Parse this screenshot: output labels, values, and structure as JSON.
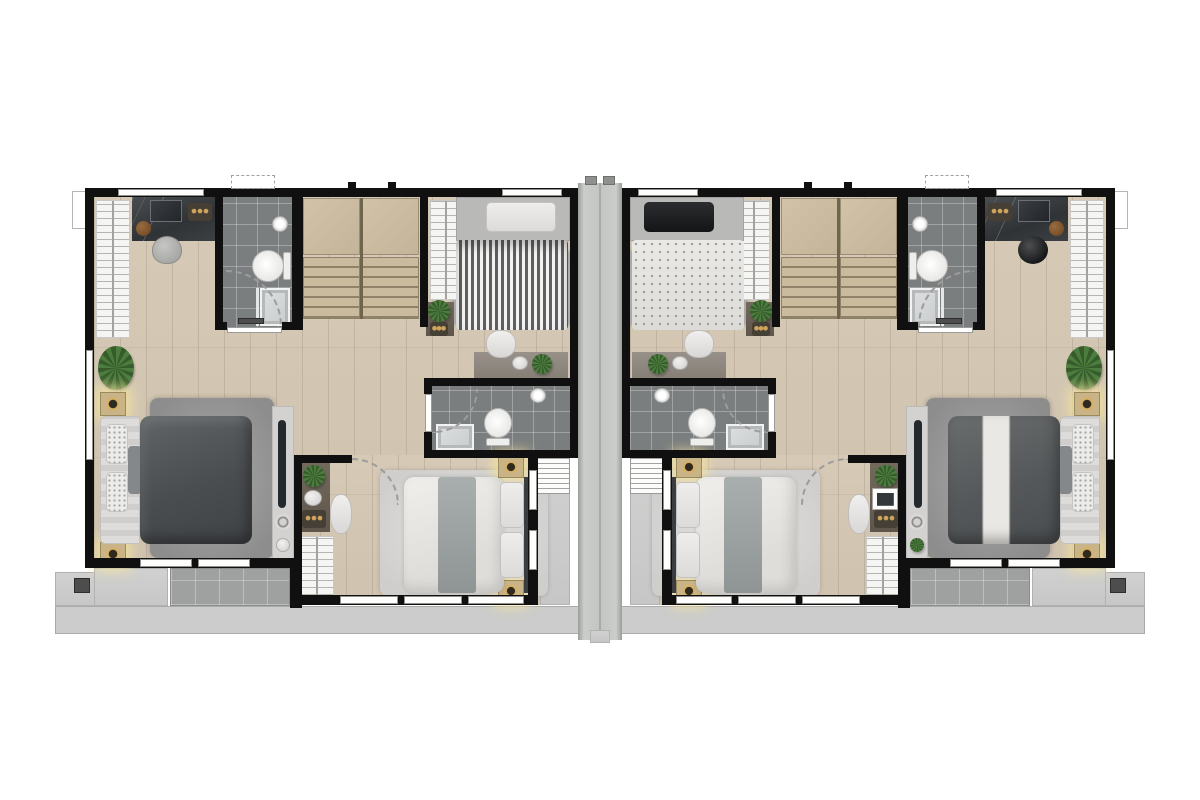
{
  "meta": {
    "description": "Top-down architectural floor plan rendering of two mirrored duplex townhouse units separated by a central concrete party wall; no visible text labels in the image",
    "units": [
      "left-unit",
      "right-unit"
    ],
    "rooms_per_unit": [
      "master-bedroom",
      "bathroom-top",
      "stairs",
      "bedroom-single",
      "bathroom-mid",
      "bedroom-double",
      "balconies"
    ]
  },
  "canvas": {
    "width": 1200,
    "height": 800,
    "background": "#ffffff"
  },
  "palette": {
    "wall": "#101010",
    "wood_floor": "#d2c6b3",
    "bathroom_tile": "#7b7e7f",
    "balcony_tile": "#9fa1a0",
    "concrete": "#c8c9c8",
    "divider_concrete": "#c3c5c3",
    "stairs": "#c4b499",
    "wardrobe": "#f5f5f4",
    "dark_bed": "#4a4d50",
    "white_bed": "#eceae7",
    "rug": "#999999",
    "lamp_glow": "#f3e2a0",
    "plant": "#4c7c3e"
  },
  "shapes": [
    {
      "name": "ground-strip",
      "cls": "concrete-strip",
      "x": 55,
      "y": 606,
      "w": 1090,
      "h": 28,
      "mirror": false
    },
    {
      "name": "side-ledge",
      "cls": "concrete-light",
      "x": 55,
      "y": 572,
      "w": 40,
      "h": 34
    },
    {
      "name": "drain-box",
      "cls": "dark-box",
      "x": 74,
      "y": 578,
      "w": 16,
      "h": 15
    },
    {
      "name": "roof-outline-box",
      "cls": "outline-box",
      "x": 72,
      "y": 191,
      "w": 68,
      "h": 38
    },
    {
      "name": "wood-floor-main",
      "cls": "wood",
      "x": 94,
      "y": 197,
      "w": 476,
      "h": 371
    },
    {
      "name": "wood-floor-bedroom2",
      "cls": "wood",
      "x": 294,
      "y": 455,
      "w": 276,
      "h": 150
    },
    {
      "name": "master-balcony-plain",
      "cls": "concrete-light",
      "x": 94,
      "y": 568,
      "w": 74,
      "h": 38
    },
    {
      "name": "master-balcony-tiled",
      "cls": "tile-balcony",
      "x": 170,
      "y": 568,
      "w": 120,
      "h": 38
    },
    {
      "name": "side-balcony",
      "cls": "concrete-light",
      "x": 540,
      "y": 455,
      "w": 30,
      "h": 150
    },
    {
      "name": "bathroom-top-floor",
      "cls": "tile-dark",
      "x": 215,
      "y": 197,
      "w": 85,
      "h": 133
    },
    {
      "name": "stair-landing-a",
      "cls": "stair-landing",
      "x": 303,
      "y": 198,
      "w": 57,
      "h": 57
    },
    {
      "name": "stair-landing-b",
      "cls": "stair-landing",
      "x": 362,
      "y": 198,
      "w": 57,
      "h": 57
    },
    {
      "name": "stair-flight-a",
      "cls": "stairs",
      "x": 303,
      "y": 257,
      "w": 57,
      "h": 62
    },
    {
      "name": "stair-flight-b",
      "cls": "stairs",
      "x": 362,
      "y": 257,
      "w": 57,
      "h": 62
    },
    {
      "name": "stair-rail",
      "cls": "rail",
      "x": 360,
      "y": 198,
      "w": 3,
      "h": 121
    },
    {
      "name": "bathroom-mid-floor",
      "cls": "tile-dark",
      "x": 428,
      "y": 382,
      "w": 142,
      "h": 72
    },
    {
      "name": "master-rug",
      "cls": "rug-dark",
      "x": 150,
      "y": 398,
      "w": 124,
      "h": 160
    },
    {
      "name": "single-bed-rug",
      "cls": "rug-gray",
      "x": 452,
      "y": 250,
      "w": 120,
      "h": 76
    },
    {
      "name": "bedroom2-rug",
      "cls": "rug-light",
      "x": 380,
      "y": 470,
      "w": 168,
      "h": 126
    },
    {
      "name": "master-wardrobe",
      "cls": "wardrobe-v",
      "x": 96,
      "y": 200,
      "w": 34,
      "h": 138
    },
    {
      "name": "vanity-counter",
      "cls": "marble",
      "x": 132,
      "y": 197,
      "w": 84,
      "h": 44
    },
    {
      "name": "vanity-mirror",
      "cls": "mirror-frame",
      "x": 150,
      "y": 200,
      "w": 32,
      "h": 22
    },
    {
      "name": "vanity-stool",
      "cls": "stool-brown",
      "x": 136,
      "y": 221,
      "w": 15,
      "h": 15
    },
    {
      "name": "vanity-tray",
      "cls": "tray-dark",
      "x": 188,
      "y": 203,
      "w": 24,
      "h": 18
    },
    {
      "name": "vanity-chair",
      "cls": "chair-gray",
      "x": 152,
      "y": 236,
      "w": 30,
      "h": 28,
      "rcls": "stool-black"
    },
    {
      "name": "corner-plant",
      "cls": "plant",
      "x": 98,
      "y": 346,
      "w": 36,
      "h": 44
    },
    {
      "name": "master-lamp-top",
      "cls": "lamp",
      "x": 100,
      "y": 392,
      "w": 26,
      "h": 24
    },
    {
      "name": "master-lamp-bottom",
      "cls": "lamp",
      "x": 100,
      "y": 542,
      "w": 26,
      "h": 24
    },
    {
      "name": "master-bed-sheet",
      "cls": "sheet-light",
      "x": 100,
      "y": 416,
      "w": 40,
      "h": 128
    },
    {
      "name": "master-bed-pillow-a",
      "cls": "pillow-pattern",
      "x": 106,
      "y": 424,
      "w": 22,
      "h": 40
    },
    {
      "name": "master-bed-pillow-b",
      "cls": "pillow-pattern",
      "x": 106,
      "y": 472,
      "w": 22,
      "h": 40
    },
    {
      "name": "master-bed-cushion",
      "cls": "cushion-gray",
      "x": 128,
      "y": 446,
      "w": 14,
      "h": 48
    },
    {
      "name": "master-bed-duvet",
      "cls": "duvet-dark",
      "x": 140,
      "y": 416,
      "w": 112,
      "h": 128,
      "rcls": "duvet-dark-throw"
    },
    {
      "name": "master-runner",
      "cls": "runner-light",
      "x": 272,
      "y": 406,
      "w": 22,
      "h": 156
    },
    {
      "name": "master-bench",
      "cls": "bench-dark",
      "x": 278,
      "y": 420,
      "w": 8,
      "h": 88
    },
    {
      "name": "master-disc",
      "cls": "disc-ring",
      "x": 275,
      "y": 514,
      "w": 16,
      "h": 16
    },
    {
      "name": "master-disc-b",
      "cls": "disc-light",
      "x": 276,
      "y": 538,
      "w": 14,
      "h": 14,
      "rcls": "plant"
    },
    {
      "name": "bedroom2-desk",
      "cls": "desk-dark",
      "x": 300,
      "y": 462,
      "w": 30,
      "h": 70
    },
    {
      "name": "bedroom2-desk-plant",
      "cls": "plant",
      "x": 303,
      "y": 465,
      "w": 22,
      "h": 22
    },
    {
      "name": "bedroom2-desk-plate",
      "cls": "disc-light",
      "x": 304,
      "y": 490,
      "w": 18,
      "h": 16
    },
    {
      "name": "bedroom2-desk-tray",
      "cls": "tray-dark",
      "x": 302,
      "y": 510,
      "w": 24,
      "h": 18
    },
    {
      "name": "bedroom2-chair",
      "cls": "chair-white",
      "x": 330,
      "y": 494,
      "w": 22,
      "h": 40
    },
    {
      "name": "bedroom2-tablet",
      "cls": "tablet",
      "x": 302,
      "y": 488,
      "w": 26,
      "h": 22,
      "side": "right"
    },
    {
      "name": "bedroom2-wardrobe",
      "cls": "wardrobe-v",
      "x": 300,
      "y": 536,
      "w": 34,
      "h": 66
    },
    {
      "name": "bedroom2-lamp-top",
      "cls": "lamp",
      "x": 498,
      "y": 456,
      "w": 26,
      "h": 22
    },
    {
      "name": "bedroom2-lamp-bottom",
      "cls": "lamp",
      "x": 498,
      "y": 580,
      "w": 26,
      "h": 22
    },
    {
      "name": "bedroom2-bed-duvet",
      "cls": "duvet-white",
      "x": 404,
      "y": 477,
      "w": 100,
      "h": 116
    },
    {
      "name": "bedroom2-bed-runner",
      "cls": "runner-gray",
      "x": 438,
      "y": 477,
      "w": 38,
      "h": 116
    },
    {
      "name": "bedroom2-pillow-a",
      "cls": "pillow-light",
      "x": 500,
      "y": 482,
      "w": 24,
      "h": 46
    },
    {
      "name": "bedroom2-pillow-b",
      "cls": "pillow-light",
      "x": 500,
      "y": 532,
      "w": 24,
      "h": 46
    },
    {
      "name": "bedroom2-headboard",
      "cls": "headboard-dark",
      "x": 524,
      "y": 477,
      "w": 5,
      "h": 116
    },
    {
      "name": "bedroom3-wardrobe",
      "cls": "wardrobe-v",
      "x": 430,
      "y": 200,
      "w": 32,
      "h": 100
    },
    {
      "name": "bedroom3-sidetable",
      "cls": "desk-dark",
      "x": 426,
      "y": 302,
      "w": 28,
      "h": 34
    },
    {
      "name": "bedroom3-sidetable-plant",
      "cls": "plant",
      "x": 428,
      "y": 300,
      "w": 22,
      "h": 22
    },
    {
      "name": "bedroom3-sidetable-tray",
      "cls": "tray-dark",
      "x": 430,
      "y": 322,
      "w": 18,
      "h": 14
    },
    {
      "name": "bedroom3-pendant-lamp",
      "cls": "lamp-round",
      "x": 476,
      "y": 199,
      "w": 25,
      "h": 25
    },
    {
      "name": "bedroom3-bed-mattress",
      "cls": "mattress-gray",
      "x": 456,
      "y": 197,
      "w": 114,
      "h": 44
    },
    {
      "name": "bedroom3-pillow",
      "cls": "pillow-light",
      "x": 486,
      "y": 202,
      "w": 70,
      "h": 30,
      "rcls": "pillow-black"
    },
    {
      "name": "bedroom3-duvet",
      "cls": "duvet-striped",
      "x": 456,
      "y": 240,
      "w": 112,
      "h": 90,
      "rcls": "duvet-dotted"
    },
    {
      "name": "bedroom3-desk",
      "cls": "desk-gray",
      "x": 474,
      "y": 352,
      "w": 94,
      "h": 26
    },
    {
      "name": "bedroom3-desk-plant",
      "cls": "plant",
      "x": 532,
      "y": 354,
      "w": 20,
      "h": 20
    },
    {
      "name": "bedroom3-desk-plate",
      "cls": "disc-light",
      "x": 512,
      "y": 356,
      "w": 16,
      "h": 14
    },
    {
      "name": "bedroom3-chair",
      "cls": "chair-white",
      "x": 486,
      "y": 330,
      "w": 30,
      "h": 28
    },
    {
      "name": "bath-top-sink",
      "cls": "sink",
      "x": 272,
      "y": 216,
      "w": 16,
      "h": 16
    },
    {
      "name": "bath-top-toilet-tank",
      "cls": "toilet-tank",
      "x": 283,
      "y": 252,
      "w": 8,
      "h": 28
    },
    {
      "name": "bath-top-toilet",
      "cls": "toilet-bowl",
      "x": 252,
      "y": 250,
      "w": 32,
      "h": 32
    },
    {
      "name": "bath-top-shower-glass",
      "cls": "glass-line",
      "x": 256,
      "y": 288,
      "w": 3,
      "h": 38
    },
    {
      "name": "bath-top-shower",
      "cls": "shower",
      "x": 260,
      "y": 288,
      "w": 30,
      "h": 38
    },
    {
      "name": "bath-top-mat",
      "cls": "dark-box",
      "x": 238,
      "y": 318,
      "w": 26,
      "h": 6
    },
    {
      "name": "bath-mid-shower",
      "cls": "shower",
      "x": 436,
      "y": 424,
      "w": 38,
      "h": 26
    },
    {
      "name": "bath-mid-toilet",
      "cls": "toilet-bowl",
      "x": 484,
      "y": 408,
      "w": 28,
      "h": 30
    },
    {
      "name": "bath-mid-toilet-tank",
      "cls": "toilet-tank",
      "x": 486,
      "y": 438,
      "w": 24,
      "h": 8
    },
    {
      "name": "bath-mid-sink",
      "cls": "sink",
      "x": 530,
      "y": 388,
      "w": 16,
      "h": 15
    },
    {
      "name": "ac-unit",
      "cls": "ac",
      "x": 536,
      "y": 456,
      "w": 34,
      "h": 38
    },
    {
      "name": "top-wall",
      "cls": "wall",
      "x": 85,
      "y": 188,
      "w": 485,
      "h": 9
    },
    {
      "name": "outer-side-wall",
      "cls": "wall",
      "x": 85,
      "y": 188,
      "w": 9,
      "h": 380
    },
    {
      "name": "party-side-wall",
      "cls": "wall",
      "x": 570,
      "y": 188,
      "w": 8,
      "h": 270
    },
    {
      "name": "bath-top-wall-left",
      "cls": "wall",
      "x": 215,
      "y": 197,
      "w": 8,
      "h": 133
    },
    {
      "name": "bath-top-wall-right",
      "cls": "wall",
      "x": 292,
      "y": 197,
      "w": 11,
      "h": 133
    },
    {
      "name": "bath-top-wall-bottom-a",
      "cls": "wall",
      "x": 215,
      "y": 322,
      "w": 12,
      "h": 8
    },
    {
      "name": "bath-top-wall-bottom-b",
      "cls": "wall",
      "x": 282,
      "y": 322,
      "w": 21,
      "h": 8
    },
    {
      "name": "stair-wall",
      "cls": "wall",
      "x": 420,
      "y": 197,
      "w": 8,
      "h": 130
    },
    {
      "name": "bath-mid-wall-top",
      "cls": "wall",
      "x": 424,
      "y": 378,
      "w": 146,
      "h": 8
    },
    {
      "name": "bath-mid-wall-bottom",
      "cls": "wall",
      "x": 424,
      "y": 450,
      "w": 146,
      "h": 8
    },
    {
      "name": "bath-mid-wall-left-a",
      "cls": "wall",
      "x": 424,
      "y": 378,
      "w": 8,
      "h": 16
    },
    {
      "name": "bath-mid-wall-left-b",
      "cls": "wall",
      "x": 424,
      "y": 432,
      "w": 8,
      "h": 26
    },
    {
      "name": "bedroom2-wall-left",
      "cls": "wall",
      "x": 294,
      "y": 455,
      "w": 8,
      "h": 150
    },
    {
      "name": "bedroom2-wall-top",
      "cls": "wall",
      "x": 294,
      "y": 455,
      "w": 58,
      "h": 8
    },
    {
      "name": "bedroom2-wall-right",
      "cls": "wall",
      "x": 528,
      "y": 455,
      "w": 10,
      "h": 150
    },
    {
      "name": "master-wall-bottom",
      "cls": "wall",
      "x": 85,
      "y": 558,
      "w": 217,
      "h": 10
    },
    {
      "name": "balcony-wall",
      "cls": "wall",
      "x": 290,
      "y": 558,
      "w": 12,
      "h": 50
    },
    {
      "name": "bedroom2-wall-bottom",
      "cls": "wall",
      "x": 294,
      "y": 595,
      "w": 244,
      "h": 10
    },
    {
      "name": "vent-tick-a",
      "cls": "wall",
      "x": 348,
      "y": 182,
      "w": 8,
      "h": 7
    },
    {
      "name": "vent-tick-b",
      "cls": "wall",
      "x": 388,
      "y": 182,
      "w": 8,
      "h": 7
    },
    {
      "name": "window-top-a",
      "cls": "window-h",
      "x": 118,
      "y": 189,
      "w": 86,
      "h": 7
    },
    {
      "name": "window-top-b",
      "cls": "window-h",
      "x": 502,
      "y": 189,
      "w": 60,
      "h": 7
    },
    {
      "name": "window-side",
      "cls": "window-v",
      "x": 86,
      "y": 350,
      "w": 7,
      "h": 110
    },
    {
      "name": "window-master-a",
      "cls": "window-h",
      "x": 140,
      "y": 559,
      "w": 52,
      "h": 8
    },
    {
      "name": "window-master-b",
      "cls": "window-h",
      "x": 198,
      "y": 559,
      "w": 52,
      "h": 8
    },
    {
      "name": "window-bedroom2-a",
      "cls": "window-h",
      "x": 340,
      "y": 596,
      "w": 58,
      "h": 8
    },
    {
      "name": "window-bedroom2-b",
      "cls": "window-h",
      "x": 404,
      "y": 596,
      "w": 58,
      "h": 8
    },
    {
      "name": "window-bedroom2-c",
      "cls": "window-h",
      "x": 468,
      "y": 596,
      "w": 56,
      "h": 8
    },
    {
      "name": "window-balconyside-a",
      "cls": "window-v",
      "x": 529,
      "y": 470,
      "w": 8,
      "h": 40
    },
    {
      "name": "window-balconyside-b",
      "cls": "window-v",
      "x": 529,
      "y": 530,
      "w": 8,
      "h": 40
    },
    {
      "name": "door-bath-top",
      "cls": "door-leaf",
      "x": 227,
      "y": 327,
      "w": 55,
      "h": 6
    },
    {
      "name": "door-bath-mid",
      "cls": "door-leaf",
      "x": 425,
      "y": 394,
      "w": 7,
      "h": 38
    },
    {
      "name": "awning-dashed",
      "cls": "awning",
      "x": 231,
      "y": 175,
      "w": 44,
      "h": 14
    },
    {
      "name": "door-arc-bath-top",
      "cls": "arc arc-tr",
      "x": 226,
      "y": 270,
      "w": 56,
      "h": 56,
      "rcls": "arc arc-tl"
    },
    {
      "name": "door-arc-bath-mid",
      "cls": "arc arc-br",
      "x": 434,
      "y": 389,
      "w": 44,
      "h": 44,
      "rcls": "arc arc-bl"
    },
    {
      "name": "door-arc-bedroom2",
      "cls": "arc arc-tr",
      "x": 352,
      "y": 458,
      "w": 47,
      "h": 47,
      "rcls": "arc arc-tl"
    },
    {
      "name": "party-wall-divider",
      "cls": "divider",
      "x": 578,
      "y": 183,
      "w": 44,
      "h": 457,
      "mirror": false
    },
    {
      "name": "divider-cap-a",
      "cls": "cap",
      "x": 585,
      "y": 176,
      "w": 12,
      "h": 9,
      "mirror": false
    },
    {
      "name": "divider-cap-b",
      "cls": "cap",
      "x": 603,
      "y": 176,
      "w": 12,
      "h": 9,
      "mirror": false
    },
    {
      "name": "divider-foot",
      "cls": "concrete-light",
      "x": 590,
      "y": 630,
      "w": 20,
      "h": 13,
      "mirror": false
    }
  ]
}
